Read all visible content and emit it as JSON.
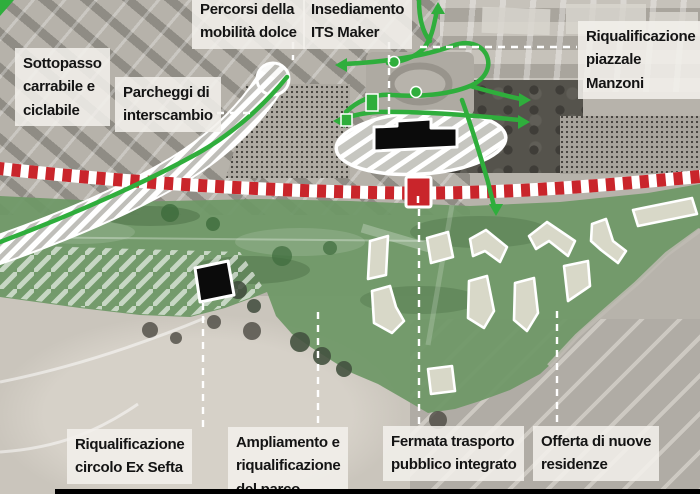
{
  "labels": {
    "percorsi": "Percorsi della\nmobilità dolce",
    "insediamento": "Insediamento\nITS Maker",
    "manzoni": "Riqualificazione\npiazzale Manzoni",
    "sottopasso": "Sottopasso\ncarrabile e\nciclabile",
    "parcheggi": "Parcheggi di\ninterscambio",
    "exsefta": "Riqualificazione\ncircolo Ex Sefta",
    "ampliamento": "Ampliamento e\nriqualificazione\ndel parco",
    "fermata": "Fermata trasporto\npubblico integrato",
    "offerta": "Offerta di nuove\nresidenze"
  },
  "map_symbols": {
    "railway_line": "red-white-striped-railway",
    "station_stop_marker": "red-square-marker",
    "station_building": "black-building-footprint",
    "ex_sefta_building": "black-building-footprint",
    "cycle_route": "green-route-with-arrows",
    "underpass_road": "white-hatched-road-band",
    "station_area": "hatched-ellipse",
    "park_area": "green-overlay",
    "new_residences": "white-outlined-building-footprints",
    "leader_line": "white-dashed-line"
  },
  "colors": {
    "railway_red": "#c9252b",
    "marker_red": "#c9252b",
    "route_green": "#2fae3c",
    "park_green": "#6e9866",
    "building_fill": "#d8d8c8",
    "label_bg": "#f2f0ec",
    "label_text": "#141414",
    "bottom_bar": "#000000"
  }
}
